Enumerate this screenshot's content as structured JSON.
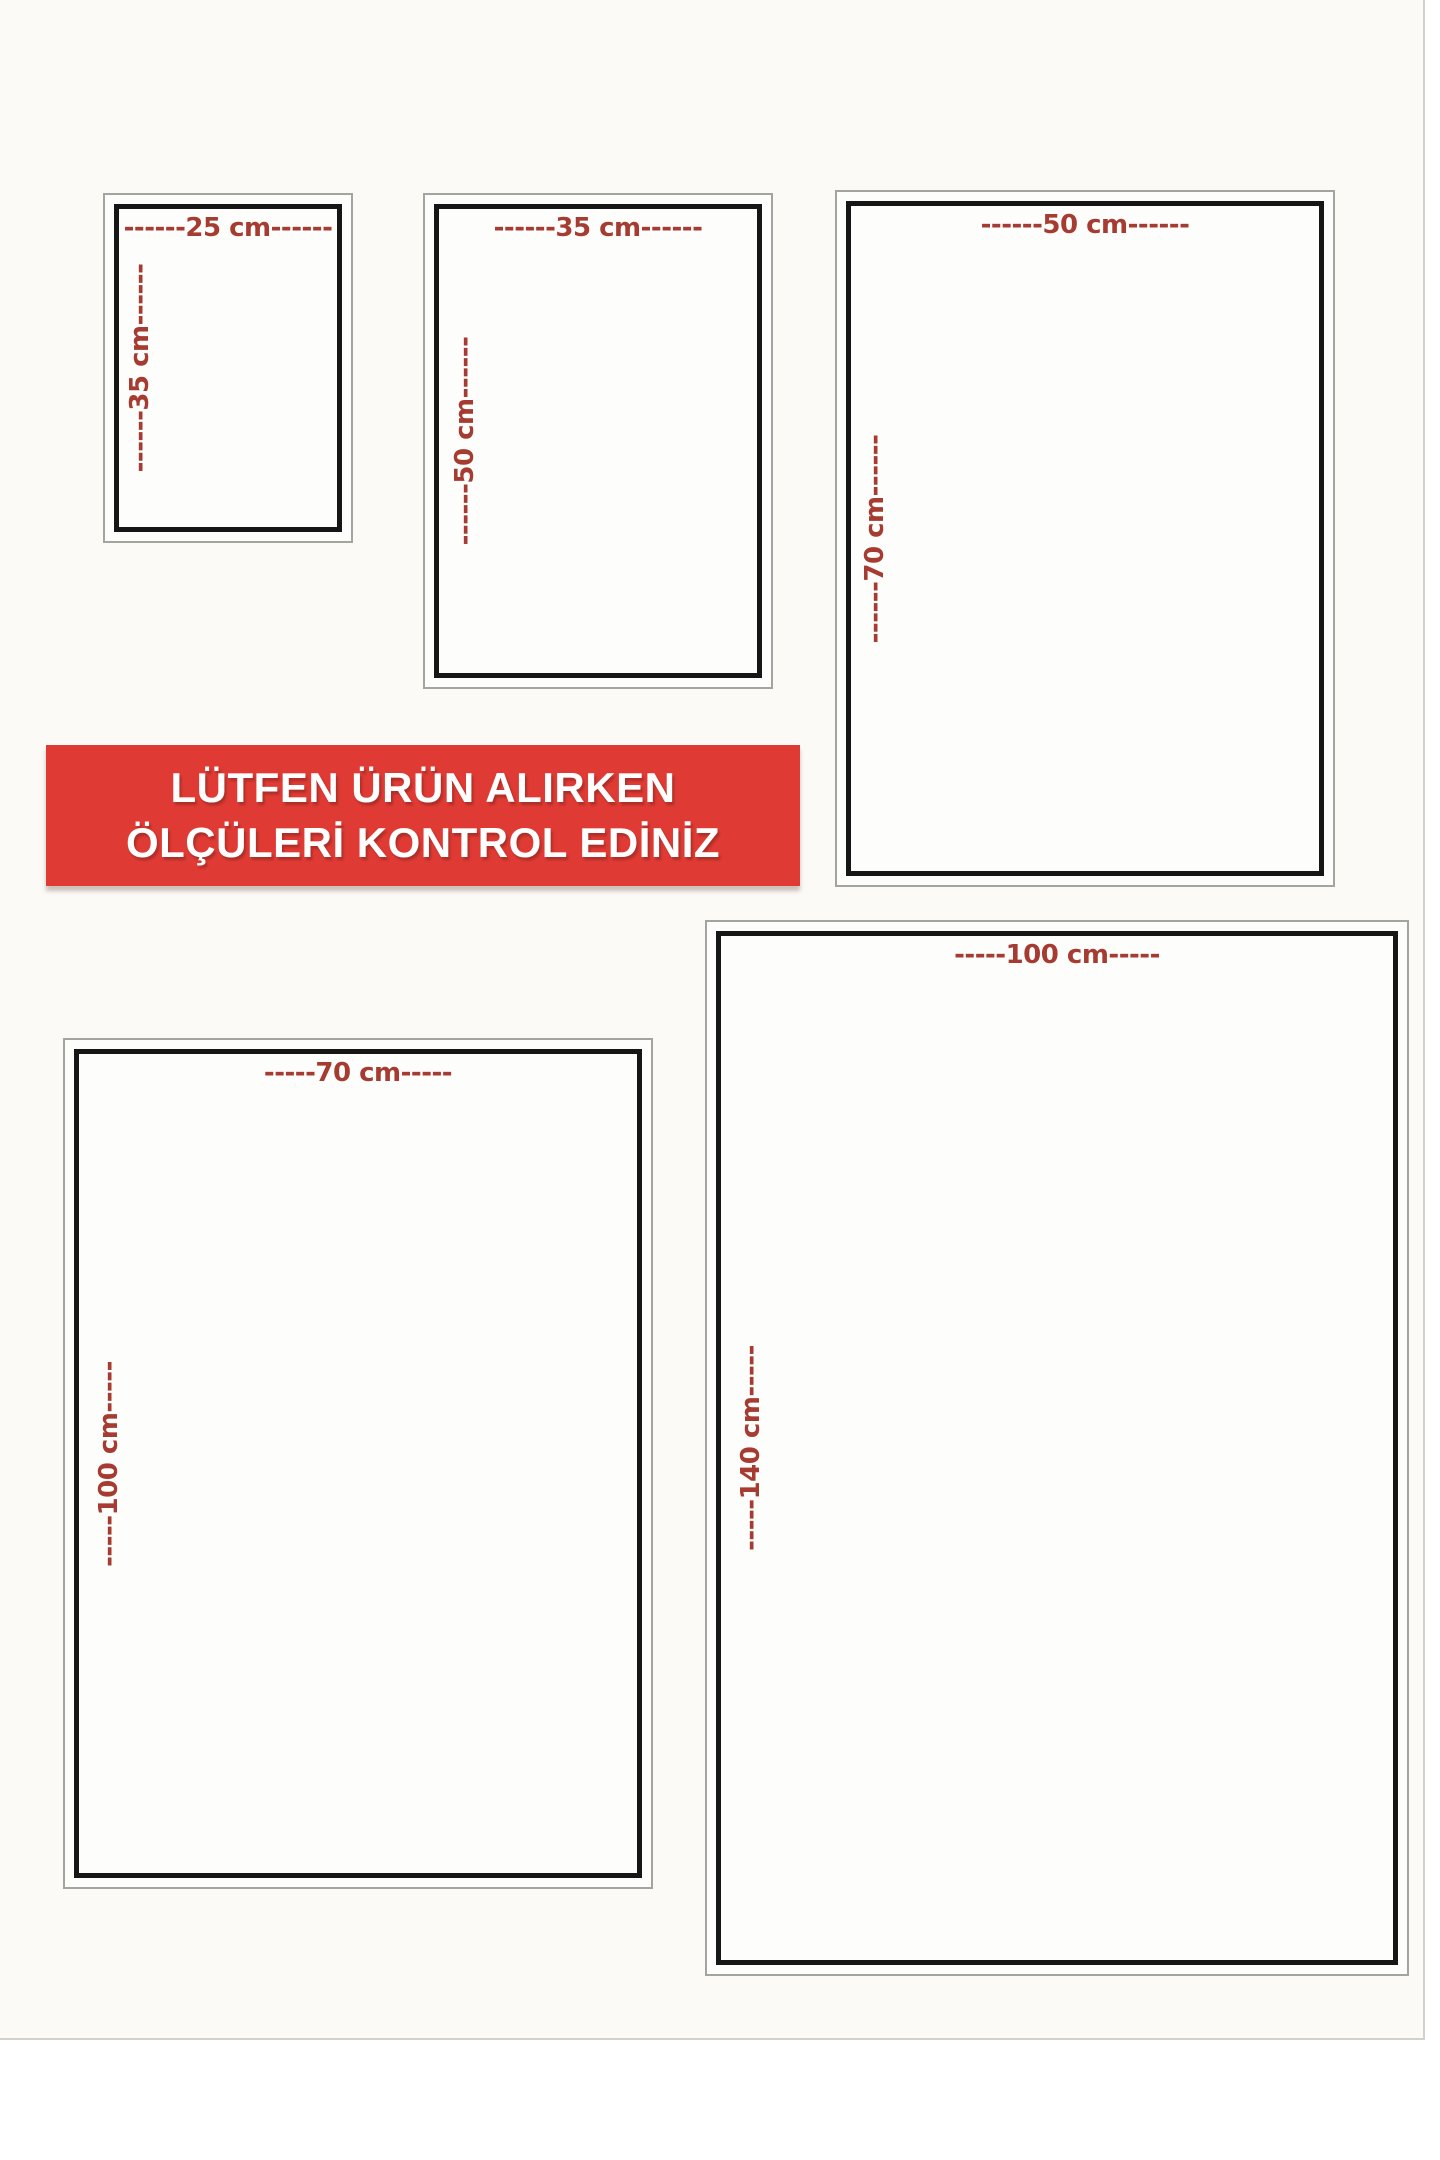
{
  "banner": {
    "line1": "LÜTFEN ÜRÜN ALIRKEN",
    "line2": "ÖLÇÜLERİ KONTROL EDİNİZ",
    "background": "#e03a34",
    "text_color": "#ffffff"
  },
  "frames": [
    {
      "name": "25x35",
      "width_cm": 25,
      "height_cm": 35,
      "width_label": "------25 cm------",
      "height_label": "------35 cm------"
    },
    {
      "name": "35x50",
      "width_cm": 35,
      "height_cm": 50,
      "width_label": "------35 cm------",
      "height_label": "------50 cm------"
    },
    {
      "name": "50x70",
      "width_cm": 50,
      "height_cm": 70,
      "width_label": "------50 cm------",
      "height_label": "------70 cm------"
    },
    {
      "name": "70x100",
      "width_cm": 70,
      "height_cm": 100,
      "width_label": "-----70 cm-----",
      "height_label": "-----100 cm-----"
    },
    {
      "name": "100x140",
      "width_cm": 100,
      "height_cm": 140,
      "width_label": "-----100 cm-----",
      "height_label": "-----140 cm-----"
    }
  ],
  "colors": {
    "label_red": "#a63b31",
    "banner_red": "#e03a34",
    "frame_black": "#161616",
    "frame_outer_gray": "#a5a3a0"
  }
}
